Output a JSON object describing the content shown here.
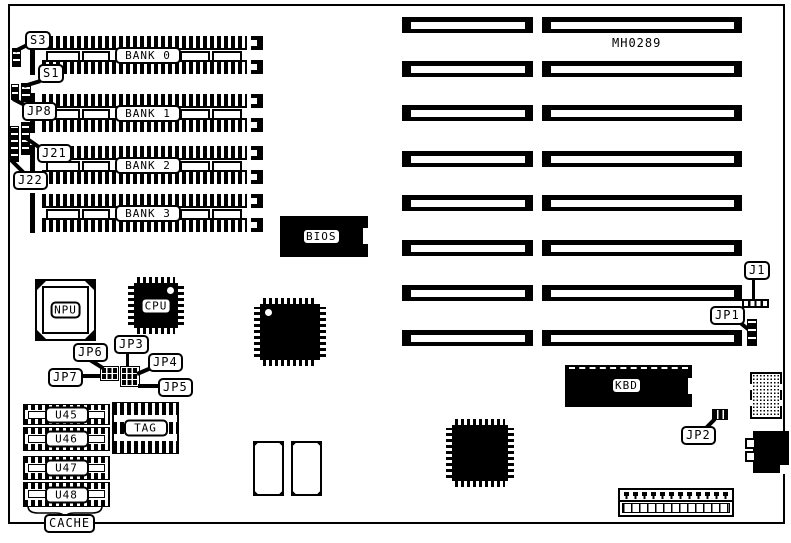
{
  "board": {
    "part_number": "MH0289"
  },
  "banks": [
    {
      "label": "BANK 0"
    },
    {
      "label": "BANK 1"
    },
    {
      "label": "BANK 2"
    },
    {
      "label": "BANK 3"
    }
  ],
  "chips": {
    "npu": "NPU",
    "cpu": "CPU",
    "bios": "BIOS",
    "kbd": "KBD",
    "tag": "TAG",
    "u45": "U45",
    "u46": "U46",
    "u47": "U47",
    "u48": "U48"
  },
  "callouts": {
    "s3": "S3",
    "s1": "S1",
    "jp8": "JP8",
    "j21": "J21",
    "j22": "J22",
    "jp6": "JP6",
    "jp3": "JP3",
    "jp4": "JP4",
    "jp7": "JP7",
    "jp5": "JP5",
    "j1": "J1",
    "jp1": "JP1",
    "jp2": "JP2",
    "cache": "CACHE"
  },
  "colors": {
    "ink": "#000000",
    "paper": "#ffffff"
  }
}
